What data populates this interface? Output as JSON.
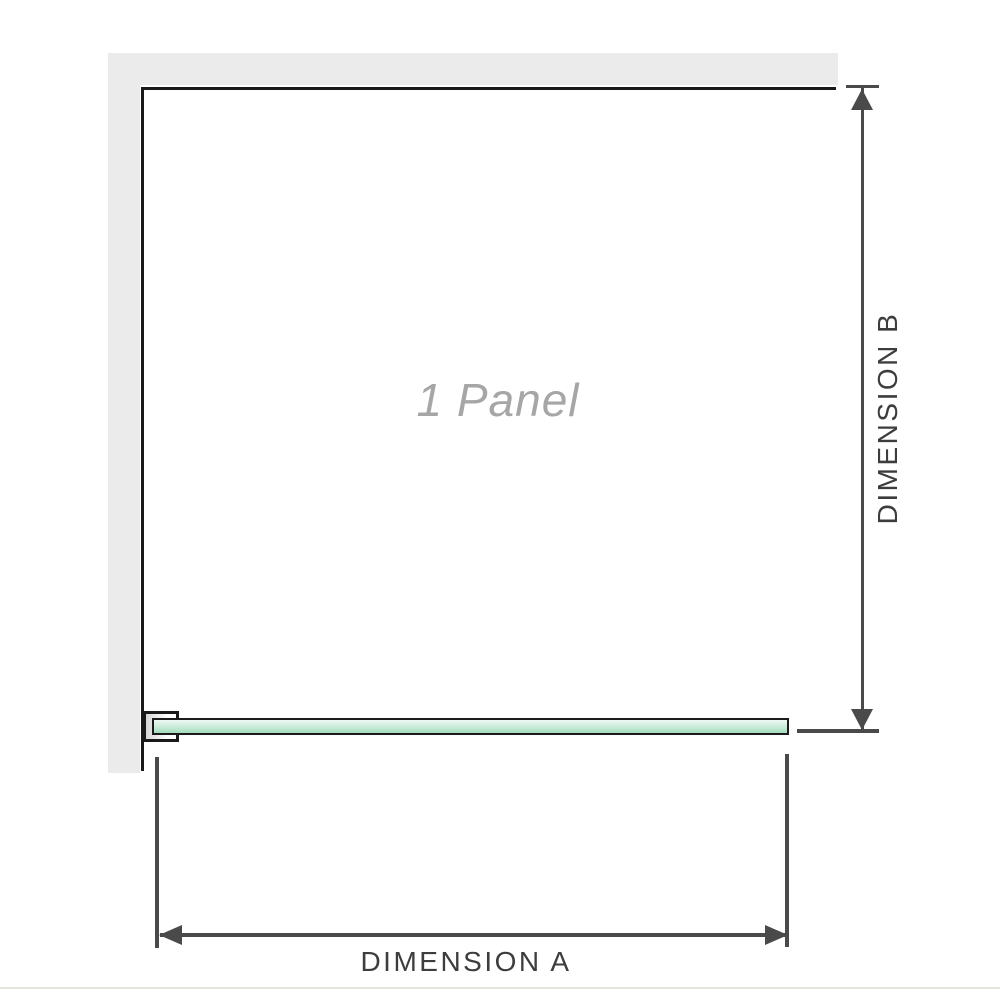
{
  "diagram": {
    "panel_label": "1 Panel",
    "dimension_a_label": "DIMENSION A",
    "dimension_b_label": "DIMENSION B"
  },
  "colors": {
    "wall": "#ebebeb",
    "panel_edge": "#1a1a1a",
    "bracket_shade": "#d6d6d6",
    "glass_border": "#1b1b1b",
    "glass_light": "#eef9f3",
    "glass_mid": "#cfeedd",
    "glass_dark": "#a3dcbe",
    "dim_line": "#4a4a4a",
    "label_dark": "#3d3d3d",
    "label_muted": "#a6a6a6",
    "baseline": "#e5e3de"
  }
}
